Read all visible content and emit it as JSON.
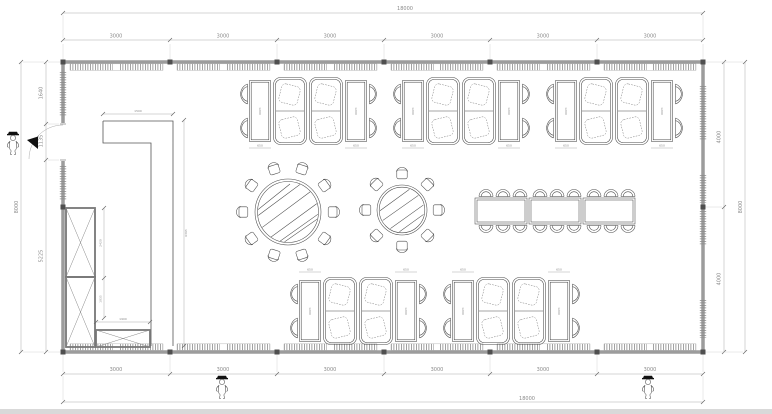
{
  "drawing": {
    "kind": "restaurant dining room floor plan"
  },
  "dimensions": {
    "top": {
      "overall": "18000",
      "segments": [
        "3000",
        "3000",
        "3000",
        "3000",
        "3000",
        "3000"
      ]
    },
    "bottom": {
      "overall": "18000",
      "segments": [
        "3000",
        "3000",
        "3000",
        "3000",
        "3000",
        "3000"
      ]
    },
    "left": {
      "overall": "8000",
      "segments": [
        "1640",
        "1135",
        "5225"
      ]
    },
    "right": {
      "overall": "8000",
      "segments": [
        "4000",
        "4000"
      ]
    },
    "counter": {
      "width": "1500",
      "length": "6365"
    },
    "cabinet": {
      "upper_height": "2420",
      "lower_height": "1035",
      "base_width": "1900"
    },
    "booth": {
      "table_width": "650",
      "table_length": "1200"
    }
  },
  "furniture": {
    "booth_clusters_top": 3,
    "booth_clusters_bottom": 2,
    "booth_cluster_items": "2 tables, 4 armchairs, 2 double booth sofas",
    "round_table_large_seats": 10,
    "round_table_small_seats": 8,
    "banquet_tables": 3,
    "banquet_seats": 18,
    "left_fixtures": "L-shaped counter, tall X-front cabinet, low X-front cabinet",
    "persons": 3
  },
  "colors": {
    "background": "#ffffff",
    "wall": "#9c9c9c",
    "furniture_line": "#4a4a4a",
    "dimension_line": "#9b9b9b",
    "text": "#8a8a8a",
    "column": "#4f4f4f",
    "door_leaf": "#111111",
    "bottom_strip": "#d9d9d9"
  }
}
